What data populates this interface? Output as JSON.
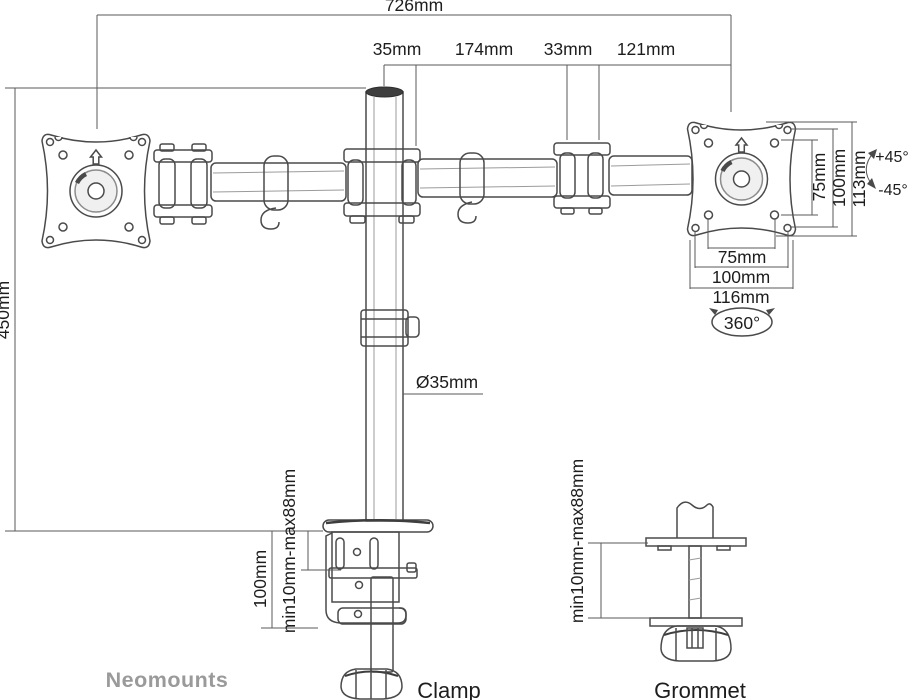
{
  "drawing": {
    "brand": "Neomounts"
  },
  "dimensions": {
    "overall_width": "726mm",
    "pole_offset": "35mm",
    "arm_length": "174mm",
    "joint_width": "33mm",
    "arm_to_vesa": "121mm",
    "pole_height": "450mm",
    "pole_diameter": "Ø35mm"
  },
  "vesa": {
    "vertical_75": "75mm",
    "vertical_100": "100mm",
    "plate_height": "113mm",
    "tilt_up": "+45°",
    "tilt_down": "-45°",
    "horizontal_75": "75mm",
    "horizontal_100": "100mm",
    "plate_width": "116mm",
    "rotation": "360°"
  },
  "clamp": {
    "label": "Clamp",
    "desk_thickness": "min10mm-max88mm",
    "bracket_height": "100mm"
  },
  "grommet": {
    "label": "Grommet",
    "desk_thickness": "min10mm-max88mm"
  },
  "colors": {
    "line": "#4a4a4a",
    "dim_line": "#5a5a5a",
    "text": "#1d1d1d",
    "brand": "#9a9a9a",
    "background": "#ffffff"
  }
}
